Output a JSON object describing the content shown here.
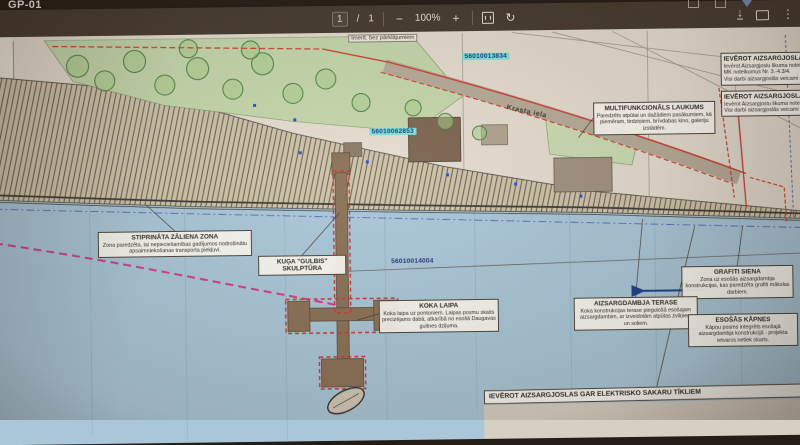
{
  "window": {
    "tab_title": "GP-01"
  },
  "toolbar": {
    "page_current": "1",
    "page_separator": "/",
    "page_total": "1",
    "zoom_out": "−",
    "zoom_value": "100%",
    "zoom_in": "+",
    "icons": {
      "rotate": "↻",
      "download_arrow": "↓",
      "more": "⋮"
    }
  },
  "plan": {
    "top_note": "Imerit. bez pārklājumiem",
    "street_label": "Krasta iela",
    "plus_mark": "+",
    "cadastre": {
      "a": "56010013834",
      "b": "56010062853",
      "c": "56010014004"
    },
    "boxes": {
      "zaliena": {
        "title": "STIPRINĀTA ZĀLIENA ZONA",
        "body": "Zona paredzēta, lai nepieciešamības gadījumos nodrošinātu apsaimniekošanas transporta piekļuvi."
      },
      "kugis": {
        "title1": "KUĢA \"GULBIS\"",
        "title2": "SKULPTŪRA"
      },
      "laipa": {
        "title": "KOKA LAIPA",
        "body": "Koka laipa uz pontoniem. Laipas posmu skaits precizējams dabā, atkarībā no esošā Daugavas gultnes dziļuma."
      },
      "laukums": {
        "title": "MULTIFUNKCIONĀLS LAUKUMS",
        "body": "Paredzēts atpūtai un dažādiem pasākumiem, kā piemēram, tirdziņiem, brīvdabas kino, galeriju izstādēm."
      },
      "grafiti": {
        "title": "GRAFITI SIENA",
        "body": "Zona uz esošās aizsargdambja konstrukcijas, kas paredzēta grafiti mākslas darbiem."
      },
      "terase": {
        "title": "AIZSARGDAMBJA TERASE",
        "body": "Koka konstrukcijas terase piegulošā esošajam aizsargdambim, ar izveidotām atpūtas zvilņiem un soliem."
      },
      "kapnes": {
        "title": "ESOŠĀS KĀPNES",
        "body": "Kāpņu posms integrēts esošajā aizsargdambja konstrukcijā - projekta ietvaros netiek skarts."
      },
      "udens": {
        "title": "IEVĒROT AIZSARGJOSLAS ŪDEN",
        "line1": "Ievērot Aizsargjoslu likuma noteikto",
        "line2": "MK noteikumus Nr. 3.-4.3/4.",
        "line3": "Visi darbi aizsargjoslās veicami sas"
      },
      "gaze": {
        "title": "IEVĒROT AIZSARGJOSLAS GĀ",
        "line1": "Ievērot Aizsargjoslu likuma noteik",
        "line2": "Visi darbi aizsargjoslās veicami sa"
      },
      "elektro": {
        "title": "IEVĒROT AIZSARGJOSLAS GAR ELEKTRISKO SAKARU TĪKLIEM"
      }
    }
  },
  "colors": {
    "toolbar_bg": "#453a31",
    "paper": "#e4ddd0",
    "water": "#a9c7d9",
    "hatch_band": "#cdc2a9",
    "greenery": "#c4d7ac",
    "red_line": "#cf3a30",
    "magenta_dash": "#d23a8c",
    "cadastre_blue": "#22367e",
    "cyan_highlight": "#7fe3da"
  }
}
